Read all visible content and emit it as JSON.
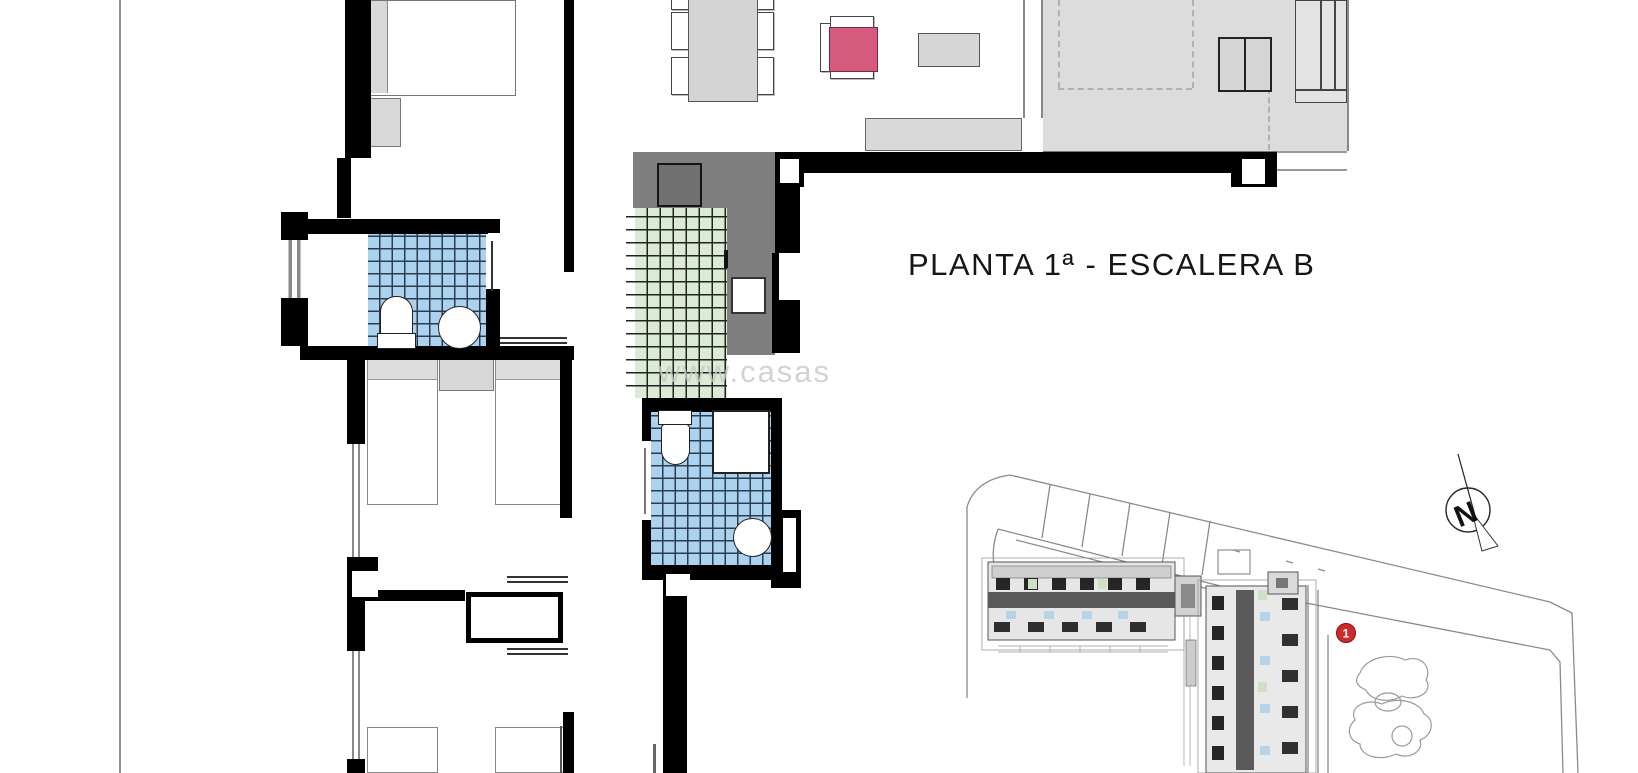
{
  "title": {
    "text": "PLANTA 1ª - ESCALERA B"
  },
  "watermark": {
    "text": "www.casas"
  },
  "site_plan": {
    "marker_label": "1",
    "compass_letter": "N"
  },
  "colors": {
    "wall_black": "#000000",
    "tile_blue": "#abd3f0",
    "tile_green": "#dcead6",
    "kitchen_counter_gray": "#7f7f7f",
    "furniture_gray": "#d9d9d9",
    "terrace_gray": "#dcdcdc",
    "accent_pink": "#d65a7d",
    "marker_red": "#cf2a2a"
  }
}
